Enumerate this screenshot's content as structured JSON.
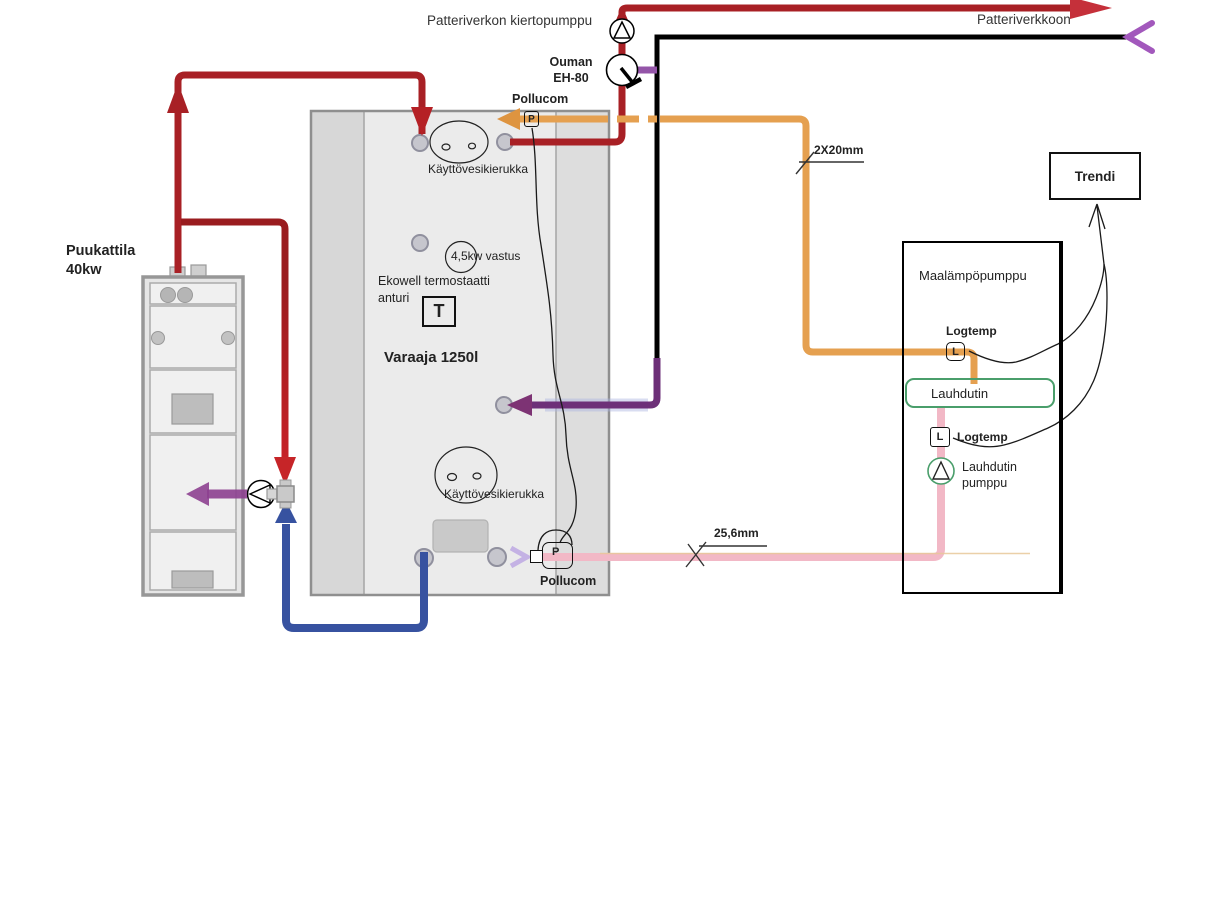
{
  "diagram_title": "Heating system piping diagram",
  "radiator_network": {
    "circulation_pump_label": "Patteriverkon kiertopumppu",
    "supply_label": "Patteriverkkoon",
    "mixing_valve_brand": "Ouman",
    "mixing_valve_model": "EH-80"
  },
  "meters": {
    "top": {
      "letter": "P",
      "label": "Pollucom"
    },
    "bottom": {
      "letter": "P",
      "label": "Pollucom"
    }
  },
  "tank": {
    "name": "Varaaja 1250l",
    "coil_top_label": "Käyttövesikierukka",
    "coil_bottom_label": "Käyttövesikierukka",
    "heater_label": "4,5kw vastus",
    "thermostat_line1": "Ekowell termostaatti",
    "thermostat_line2": "anturi",
    "thermostat_letter": "T"
  },
  "boiler": {
    "name_line1": "Puukattila",
    "name_line2": "40kw"
  },
  "heat_pump": {
    "name": "Maalämpöpumppu",
    "sensor_top": {
      "letter": "L",
      "label": "Logtemp"
    },
    "sensor_bottom": {
      "letter": "L",
      "label": "Logtemp"
    },
    "condenser_label": "Lauhdutin",
    "condenser_pump_line1": "Lauhdutin",
    "condenser_pump_line2": "pumppu"
  },
  "trend": {
    "label": "Trendi"
  },
  "dimensions": {
    "orange_pipe": "2X20mm",
    "pink_pipe": "25,6mm"
  },
  "colors": {
    "hot_supply_red": "#a82025",
    "bright_red_arrow": "#c5303a",
    "return_blue": "#3752a0",
    "purple_return": "#6d3078",
    "light_purple": "#a258bc",
    "orange_pipe": "#e5a050",
    "pink_pipe": "#f2b8c6",
    "black_pipe": "#000000",
    "condenser_green": "#4a9e6b"
  }
}
